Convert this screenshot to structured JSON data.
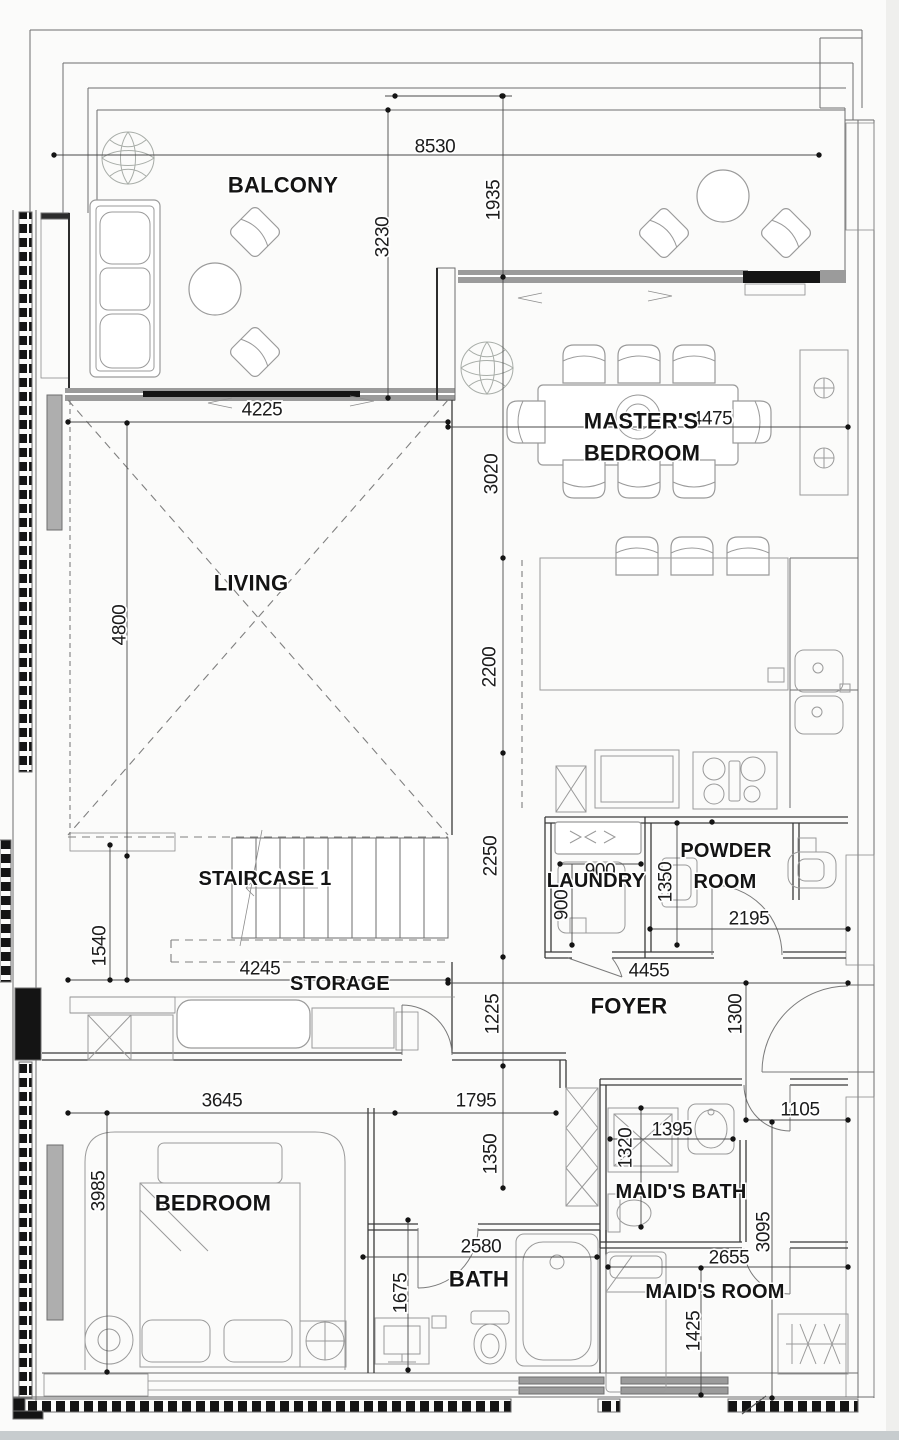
{
  "drawing_type": "apartment floor plan",
  "rooms": {
    "balcony": "BALCONY",
    "masters_line1": "MASTER'S",
    "masters_line2": "BEDROOM",
    "living": "LIVING",
    "staircase1": "STAIRCASE 1",
    "laundry": "LAUNDRY",
    "powder_line1": "POWDER",
    "powder_line2": "ROOM",
    "storage": "STORAGE",
    "foyer": "FOYER",
    "bedroom": "BEDROOM",
    "maids_bath": "MAID'S BATH",
    "bath": "BATH",
    "maids_room": "MAID'S ROOM"
  },
  "dims": {
    "d8530": "8530",
    "d4225": "4225",
    "d4475": "4475",
    "d4245": "4245",
    "d4455": "4455",
    "d3645": "3645",
    "d1795": "1795",
    "d1105": "1105",
    "d2195": "2195",
    "d1395": "1395",
    "d2580": "2580",
    "d2655": "2655",
    "d900_laundry_h": "900",
    "d3230": "3230",
    "d1935": "1935",
    "d3020": "3020",
    "d2200": "2200",
    "d2250": "2250",
    "d1225": "1225",
    "d1350_corridor": "1350",
    "d4800": "4800",
    "d1540": "1540",
    "d3985": "3985",
    "d900_laundry_v": "900",
    "d1350_laundry": "1350",
    "d1300": "1300",
    "d1320": "1320",
    "d1675": "1675",
    "d3095": "3095",
    "d1425": "1425"
  },
  "colors": {
    "paper": "#fbfbfa",
    "wall_gray": "#9b9b9b",
    "wall_black": "#141414",
    "hatch_line": "#b8b8b8",
    "dim_line": "#4a4a4a",
    "label_text": "#141414",
    "page_edge": "#c7ccce"
  }
}
